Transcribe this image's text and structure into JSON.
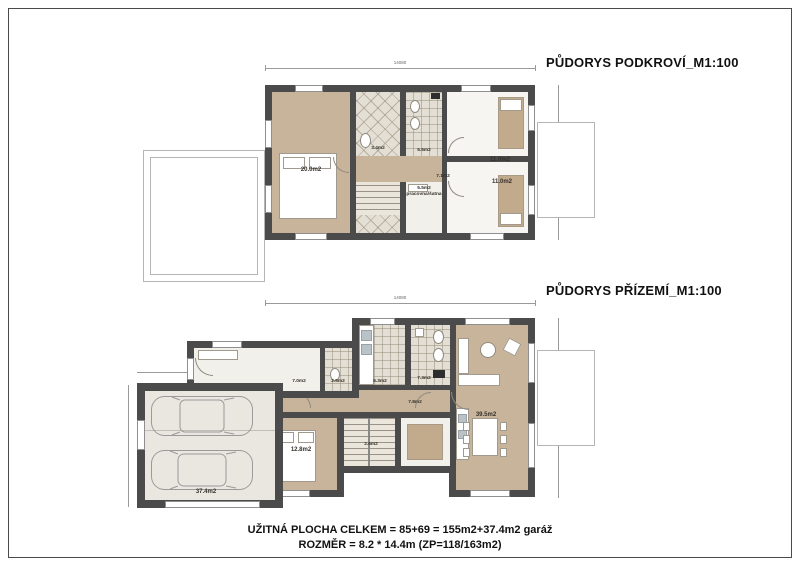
{
  "titles": {
    "attic": "PŮDORYS PODKROVÍ_M1:100",
    "ground": "PŮDORYS PŘÍZEMÍ_M1:100"
  },
  "footer": {
    "line1": "UŽITNÁ PLOCHA CELKEM = 85+69 = 155m2+37.4m2 garáž",
    "line2": "ROZMĚR = 8.2 * 14.4m (ZP=118/163m2)"
  },
  "attic": {
    "dims": {
      "top": "14080",
      "right": "8200"
    },
    "rooms": {
      "bedroom": "20.0m2",
      "bath_small": "3.4m2",
      "bath": "5.5m2",
      "hall": "7.1m2",
      "study_area": "5.5m2",
      "study_name": "pracovna/šatna",
      "room_top_right": "11.0m2",
      "room_bottom_right": "11.0m2"
    }
  },
  "ground": {
    "dims": {
      "top": "14080",
      "right": "8200",
      "garage_top": "6400"
    },
    "rooms": {
      "entry": "7.0m2",
      "wc": "2.5m2",
      "kitchen": "6.3m2",
      "bath": "7.3m2",
      "hall": "7.8m2",
      "bedroom": "12.8m2",
      "stairs": "2.6m2",
      "living": "39.5m2",
      "garage": "37.4m2"
    }
  },
  "colors": {
    "wall": "#4b4b4b",
    "floor_tan": "#c8b49a",
    "floor_tile": "#e4dfd4",
    "accent_line": "#9a9a9a"
  }
}
